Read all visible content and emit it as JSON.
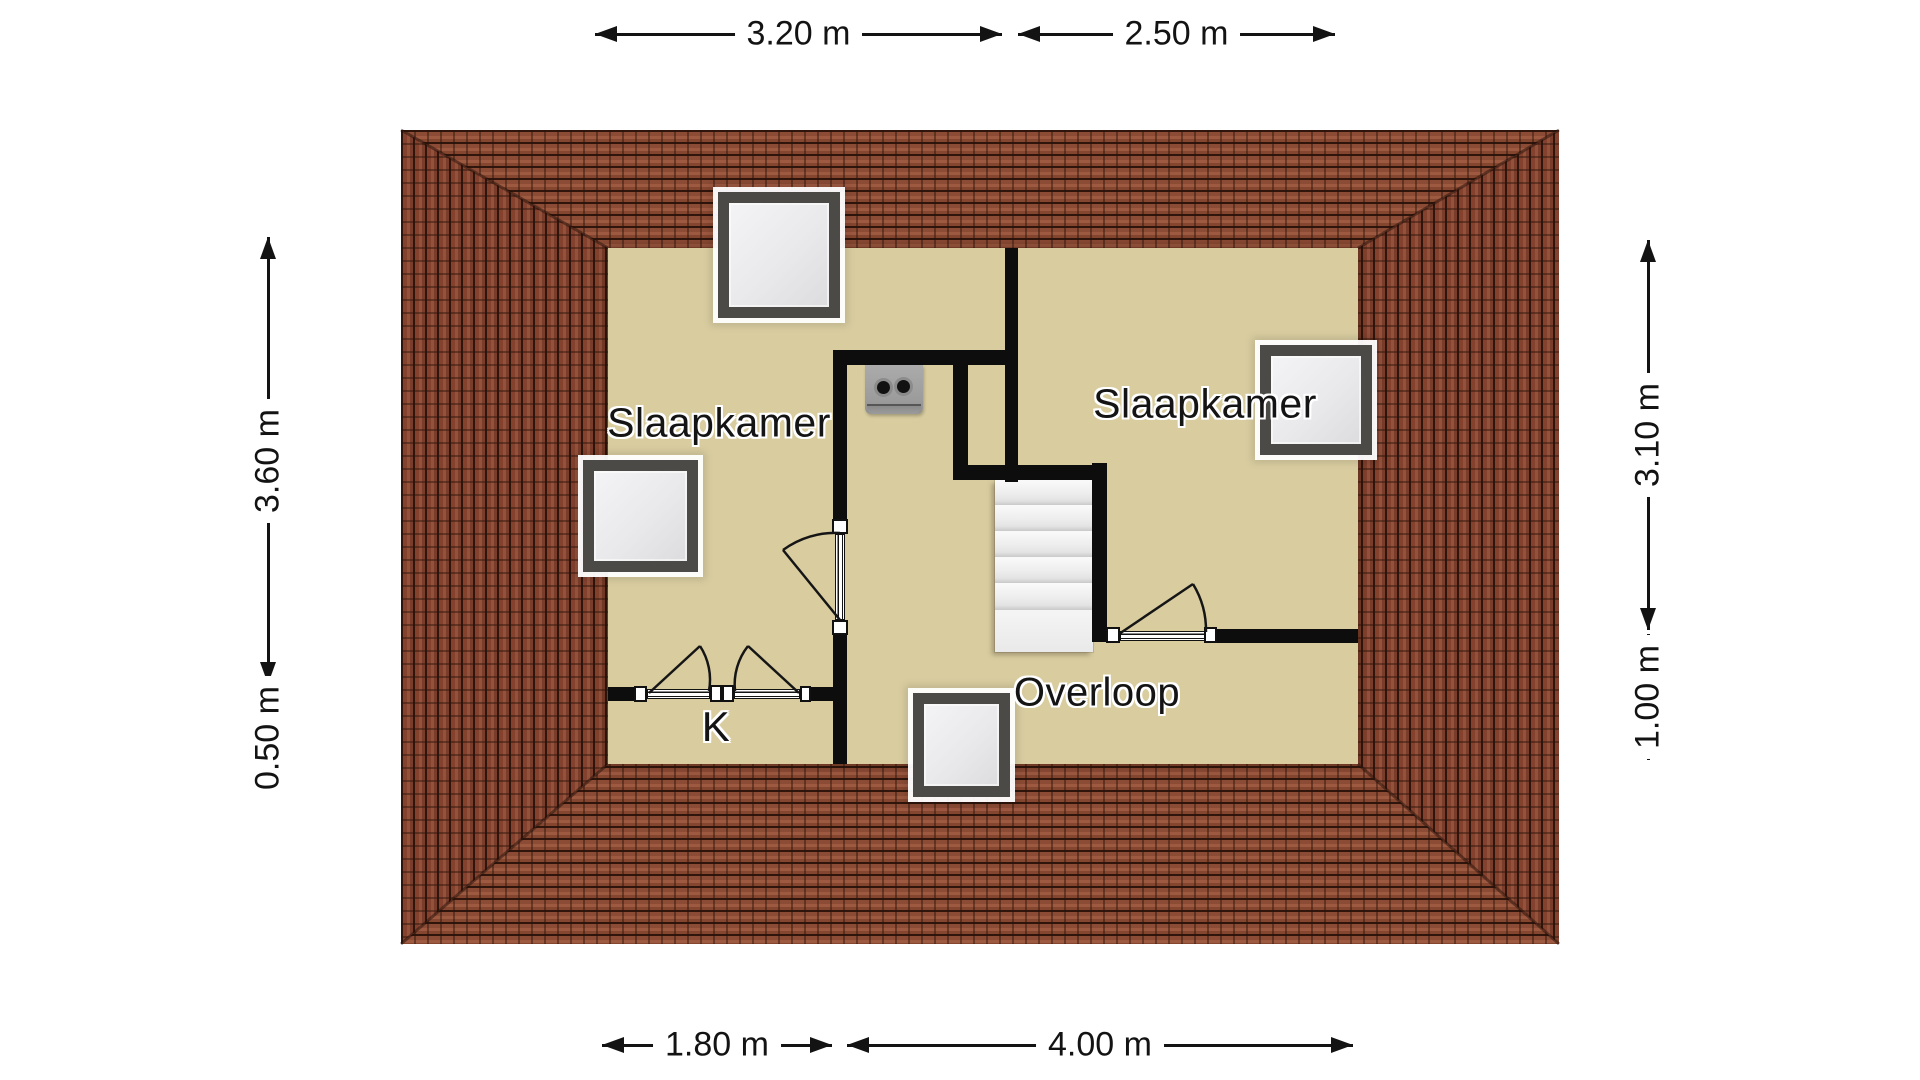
{
  "floorplan": {
    "rooms": {
      "bedroom_left": "Slaapkamer",
      "bedroom_right": "Slaapkamer",
      "landing": "Overloop",
      "closet": "K"
    },
    "dimensions": {
      "top": [
        "3.20 m",
        "2.50 m"
      ],
      "bottom": [
        "1.80 m",
        "4.00 m"
      ],
      "left": [
        "3.60 m",
        "0.50 m"
      ],
      "right": [
        "3.10 m",
        "1.00 m"
      ]
    },
    "colors": {
      "floor": "#d9cda0",
      "wall": "#0d0d0d",
      "roof_tile": "#8b4b34",
      "roof_tile_dark": "#2f150b",
      "skylight_frame": "#4b4a47",
      "stairs": "#ededed",
      "mv_unit": "#9c9c9c",
      "dimension_text": "#131313"
    }
  }
}
